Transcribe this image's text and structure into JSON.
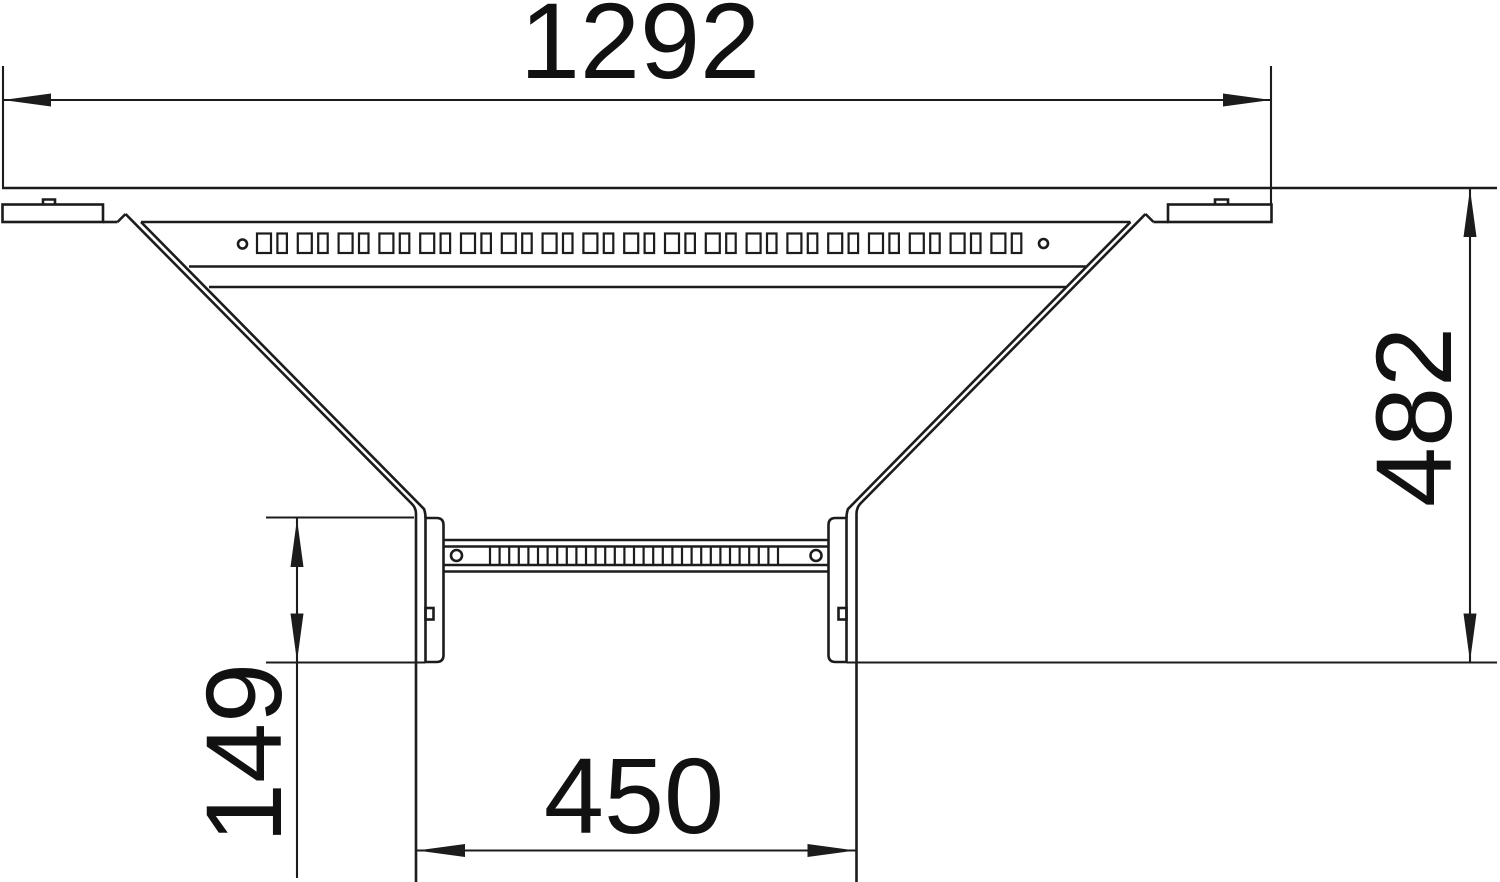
{
  "drawing": {
    "dimensions": {
      "top_width": "1292",
      "right_height": "482",
      "left_branch_depth": "149",
      "bottom_branch_width": "450"
    },
    "style": {
      "line_color": "#1c1c1c",
      "text_color": "#111111",
      "background_color": "#ffffff"
    },
    "perforations": {
      "main_rail_slot_count": 38,
      "main_rail_hole_count": 2,
      "rung_tick_count": 31,
      "rung_hole_count": 2
    }
  }
}
